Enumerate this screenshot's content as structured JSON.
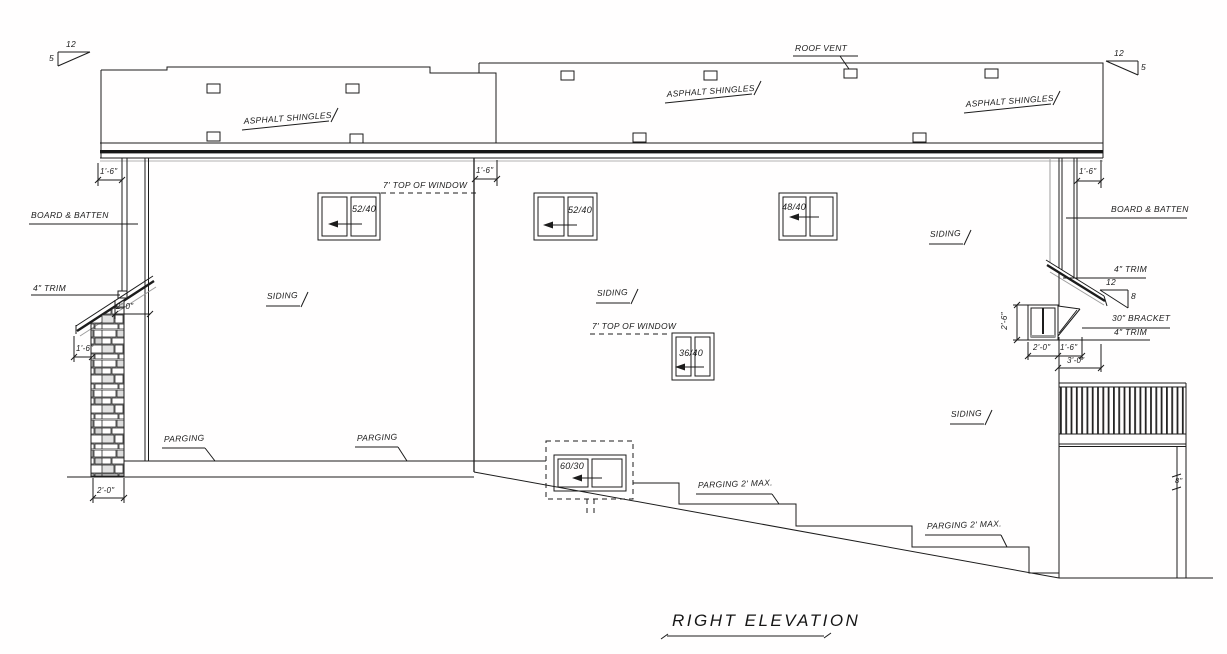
{
  "title": {
    "text": "RIGHT ELEVATION"
  },
  "roof": {
    "vent_label": "ROOF VENT",
    "shingles": {
      "left": "ASPHALT SHINGLES",
      "middle": "ASPHALT SHINGLES",
      "right": "ASPHALT SHINGLES"
    },
    "slope_left": {
      "run": "12",
      "rise": "5"
    },
    "slope_right": {
      "run": "12",
      "rise": "5"
    },
    "slope_bay": {
      "run": "12",
      "rise": "8"
    }
  },
  "siding_labels": {
    "left": "SIDING",
    "middle": "SIDING",
    "right_upper": "SIDING",
    "right_lower": "SIDING"
  },
  "trim_labels": {
    "board_batten_left": "BOARD & BATTEN",
    "board_batten_right": "BOARD & BATTEN",
    "trim_left": "4\" TRIM",
    "trim_right_upper": "4\" TRIM",
    "trim_right_lower": "4\" TRIM",
    "bracket": "30\" BRACKET"
  },
  "parging_labels": {
    "left_1": "PARGING",
    "left_2": "PARGING",
    "max_1": "PARGING 2' MAX.",
    "max_2": "PARGING 2' MAX."
  },
  "window_notes": {
    "top_of_window_upper": "7' TOP OF WINDOW",
    "top_of_window_lower": "7' TOP OF WINDOW"
  },
  "windows": {
    "w1": "52/40",
    "w2": "52/40",
    "w3": "48/40",
    "w4": "36/40",
    "w5": "60/30"
  },
  "dimensions": {
    "overhang_left": "1'-6\"",
    "overhang_middle": "1'-6\"",
    "overhang_right": "1'-6\"",
    "pillar_width": "2'-0\"",
    "porch_depth": "2'-0\"",
    "pillar_offset": "1'-6\"",
    "bay_height": "2'-6\"",
    "bay_width": "2'-0\"",
    "bracket_depth": "1'-6\"",
    "bay_total": "3'-0\"",
    "garage_jamb": "8\""
  },
  "colors": {
    "line": "#1c1c1c",
    "accent_gray": "#a8a8a8",
    "paper": "#ffffff"
  }
}
